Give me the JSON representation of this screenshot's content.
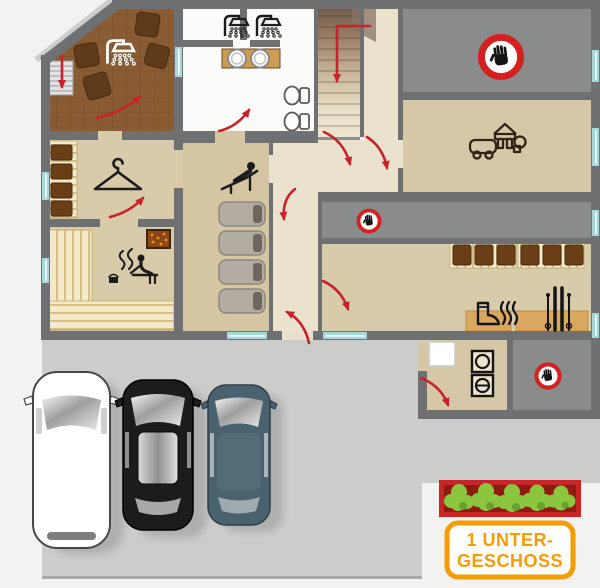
{
  "sign": {
    "line1": "1 UNTER-",
    "line2": "GESCHOSS"
  },
  "colors": {
    "background": "#f2f2f1",
    "parking": "#cccccb",
    "wall_gray": "#6f7071",
    "restricted_room_gray": "#8a8b8b",
    "floor_beige": "#d6c8a6",
    "corridor_cream": "#eae2cd",
    "terrace_brown": "#8a5c33",
    "bench_wood": "#f4e9c8",
    "locker_brown": "#6b3f16",
    "mat_tan": "#d9a75f",
    "window_teal": "#a5d8db",
    "arrow_red": "#c8222a",
    "hand_sign_red": "#d42020",
    "sign_orange": "#f59c00",
    "hedge_green": "#8cc63f",
    "hedge_frame_red": "#c8252b",
    "car_white": "#ffffff",
    "car_black": "#1c1c1c",
    "car_slate": "#4a626e"
  },
  "icons": {
    "no_entry": "no-entry-hand-icon",
    "shower": "shower-icon",
    "hanger": "coat-hanger-icon",
    "sauna": "sauna-person-icon",
    "relax": "person-on-lounger-icon",
    "toys": "toy-blocks-and-car-icon",
    "boot_dryer": "boot-dryer-icon",
    "skis": "skis-icon",
    "washer_dryer": "washer-dryer-icon",
    "toilet": "toilet-icon",
    "sink": "sink-icon"
  }
}
